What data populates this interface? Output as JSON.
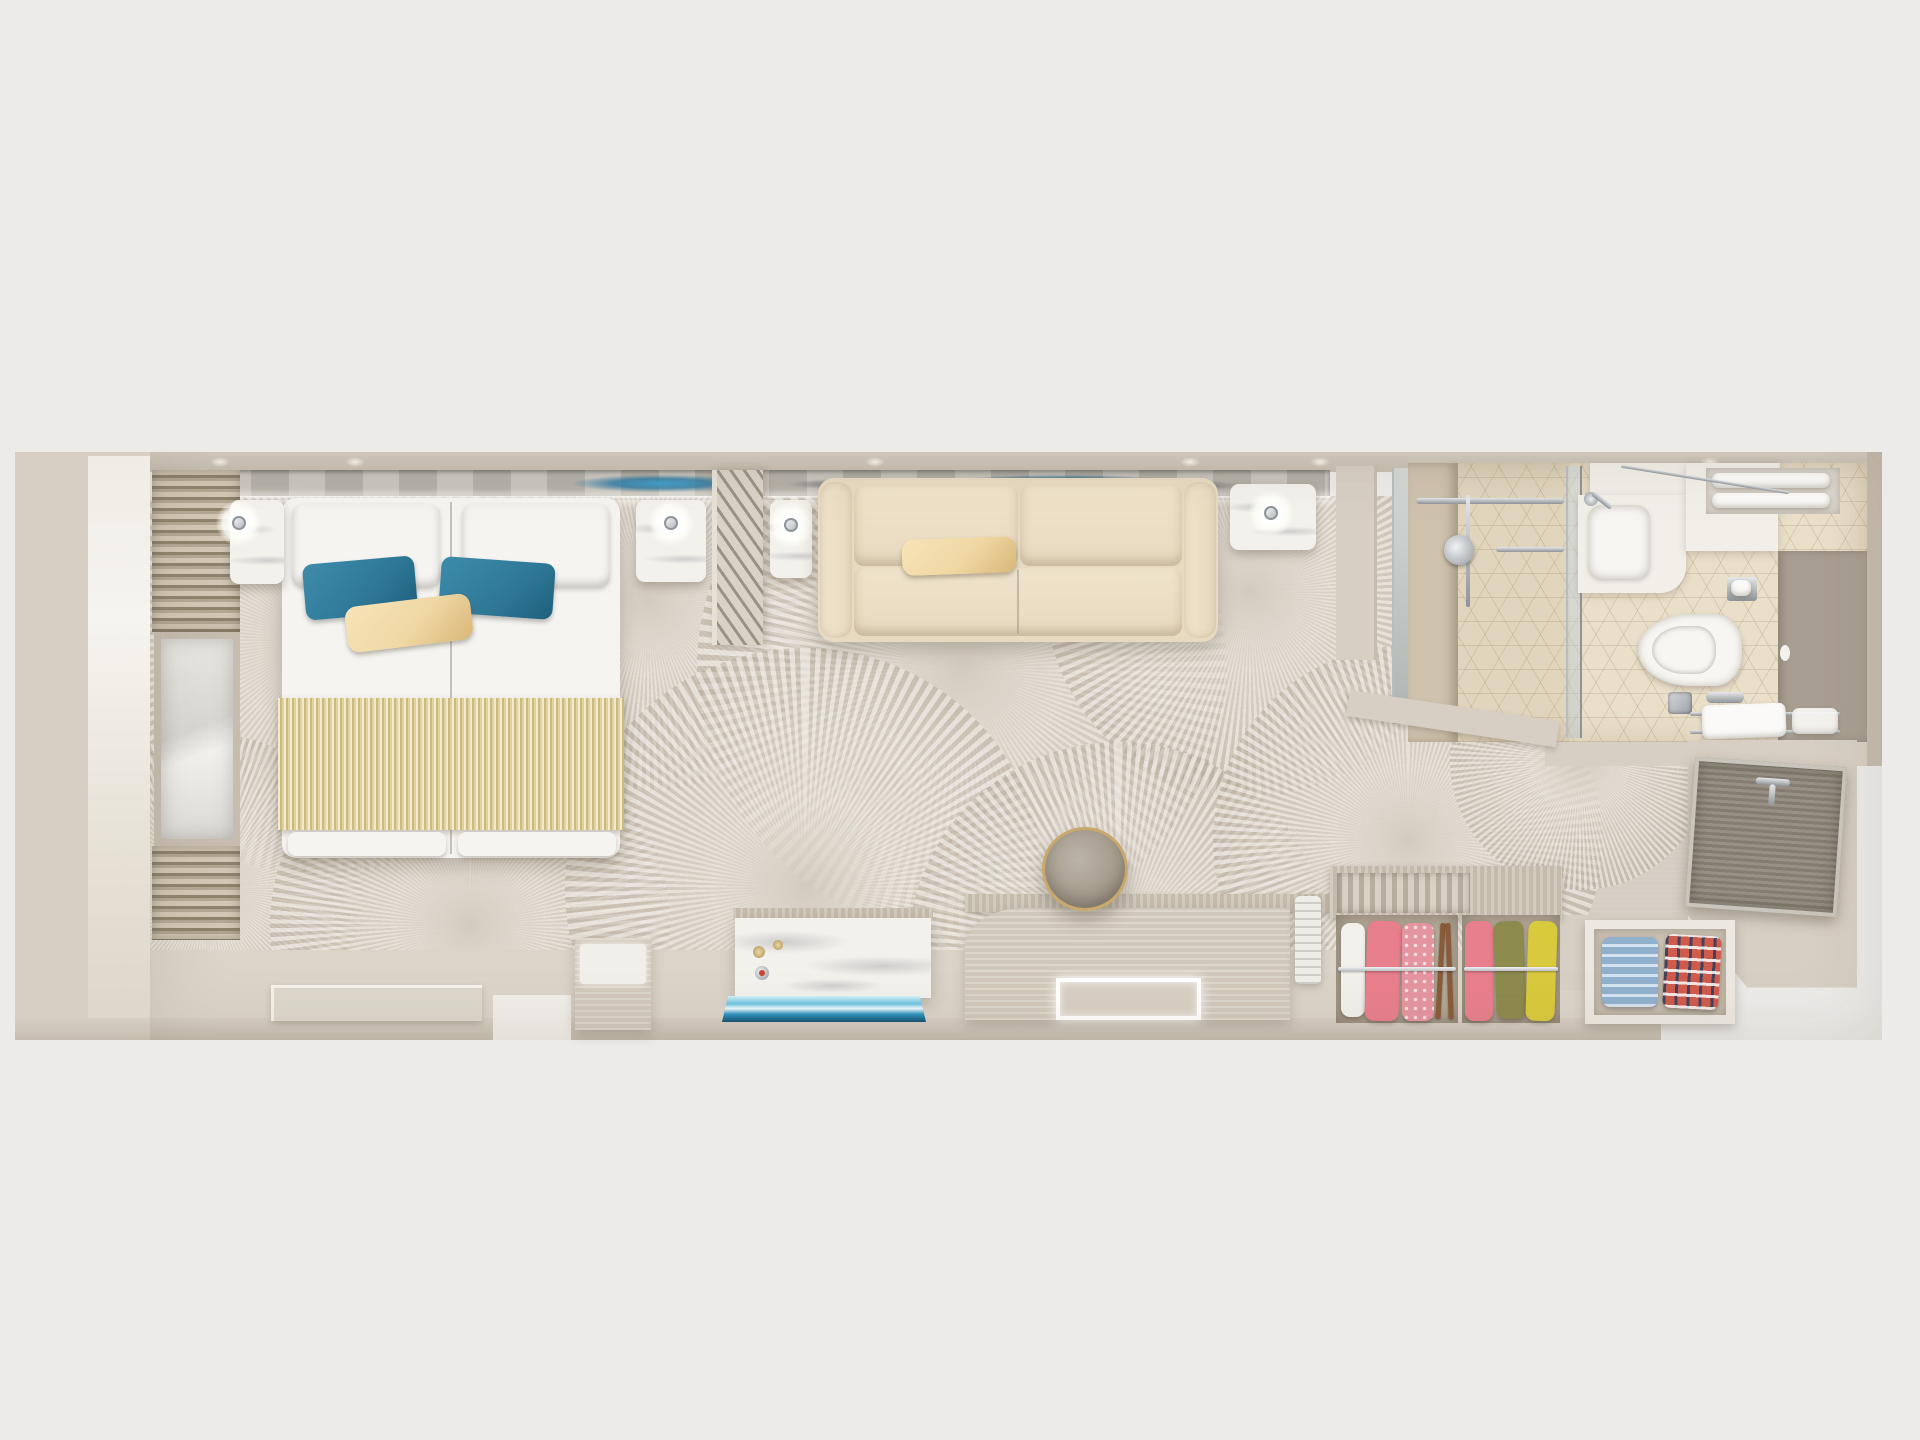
{
  "scene": {
    "label": "Top-down 3D rendered floor plan of a cruise-ship stateroom",
    "areas": [
      "bedroom",
      "living-area",
      "bathroom",
      "entry-hall"
    ],
    "visible_text": "none"
  },
  "palette": {
    "bg": "#ECEBE9",
    "wall": "#D7CFC4",
    "wall_dark": "#C6BDAF",
    "floor": "#DBD4C9",
    "floor_light": "#F0EEE8",
    "carpet": "#D6CEC4",
    "art_silver": "#C9C5BE",
    "art_silver2": "#B3AFA7",
    "art_blue": "#3E9ECD",
    "bed_white": "#F5F4F1",
    "runner": "#E2D29A",
    "pillow_teal": "#2E7896",
    "pillow_tan": "#F0D8A4",
    "sofa": "#E8DAC0",
    "marble": "#F3F1EC",
    "marble_vein": "rgba(150,152,158,0.4)",
    "chrome": "#B9BDC0",
    "chrome_dark": "#8E9498",
    "tile": "#EADFC9",
    "tile_line": "rgba(172,148,108,0.28)",
    "white_goods": "#F2EFE9",
    "taupe_panel": "#A89E91",
    "toilet": "#F8F6F3",
    "door": "#8F8779",
    "door_frame": "#C9C5BC",
    "desk_wood": "#D8D0C3",
    "counter_wood": "#CDC5B7",
    "stool": "#A29989",
    "stool_ring": "#C9A96B",
    "mat": "#DDD7CC",
    "ac_white": "#EFEDE8",
    "louver_a": "#B7AE9F",
    "louver_b": "#D9D1C4",
    "slat_a": "#D2C7B4",
    "slat_b": "#8F836D",
    "mirror_a": "#ECEAE6",
    "mirror_b": "#D9D7D3",
    "hanger_wood": "#8A5B38",
    "cloth_white": "#F2F0EB",
    "cloth_pink": "#E87F8C",
    "cloth_rose": "#E595A0",
    "cloth_olive": "#8D8A4E",
    "cloth_yellow": "#D9C93C",
    "cloth_blue": "#A9C7DF",
    "plaid_red": "#CF5B4C"
  },
  "carpet": {
    "pattern": "overlapping sunburst medallions",
    "medallions": [
      {
        "x": 320,
        "y": 640,
        "r": 235
      },
      {
        "x": 648,
        "y": 600,
        "r": 190
      },
      {
        "x": 962,
        "y": 668,
        "r": 265
      },
      {
        "x": 1250,
        "y": 592,
        "r": 205
      },
      {
        "x": 208,
        "y": 888,
        "r": 155
      },
      {
        "x": 470,
        "y": 925,
        "r": 200
      },
      {
        "x": 805,
        "y": 888,
        "r": 240
      },
      {
        "x": 1118,
        "y": 952,
        "r": 210
      },
      {
        "x": 1408,
        "y": 840,
        "r": 195
      },
      {
        "x": 1580,
        "y": 760,
        "r": 130
      }
    ]
  },
  "bedroom": {
    "label": "bedroom",
    "bed": {
      "mattresses": 2,
      "duvet": "white",
      "runner": "gold ribbed",
      "pillows": [
        "white",
        "white",
        "teal",
        "teal",
        "tan lumbar"
      ]
    },
    "nightstands": [
      {
        "material": "white marble",
        "lamp": true
      },
      {
        "material": "white marble",
        "lamp": true
      }
    ],
    "window_wall": {
      "blinds": "louvered",
      "mirror_panel": true
    },
    "headboard_art": {
      "style": "silver metallic with blue sea swirls"
    }
  },
  "living": {
    "label": "living area",
    "divider": {
      "style": "slatted screen"
    },
    "sofa": {
      "color": "cream",
      "seats": 2,
      "lumbar_pillow": "tan"
    },
    "side_tables": [
      {
        "material": "white marble",
        "lamp": true
      },
      {
        "material": "white marble",
        "lamp": true
      }
    ],
    "tv_console": {
      "front": "white marble",
      "tv": "wall-mounted, on (blue sea scene)"
    },
    "desk": {
      "material": "light wood",
      "tray": "LED-lit",
      "stool": "round taupe with gold ring"
    },
    "wardrobe": {
      "sections": [
        {
          "type": "hanging",
          "clothes": [
            "white",
            "pink",
            "rose patterned"
          ]
        },
        {
          "type": "hanging",
          "clothes": [
            "pink",
            "olive",
            "yellow"
          ]
        },
        {
          "type": "shelf",
          "clothes": [
            "folded light-blue",
            "folded plaid shirt"
          ]
        }
      ],
      "vent": "louvered top"
    }
  },
  "bathroom": {
    "label": "bathroom",
    "fixtures": [
      "walk-in shower with glass front",
      "marble counter with sink",
      "wall-hung toilet",
      "towel shelf with rolled towels",
      "toilet-paper holder",
      "floor drain",
      "towel rail bench"
    ],
    "floor": "beige cube-pattern tile"
  },
  "entry": {
    "label": "entry hall",
    "door": {
      "color": "taupe grey",
      "handle": "chrome",
      "angle_deg": 4
    }
  }
}
